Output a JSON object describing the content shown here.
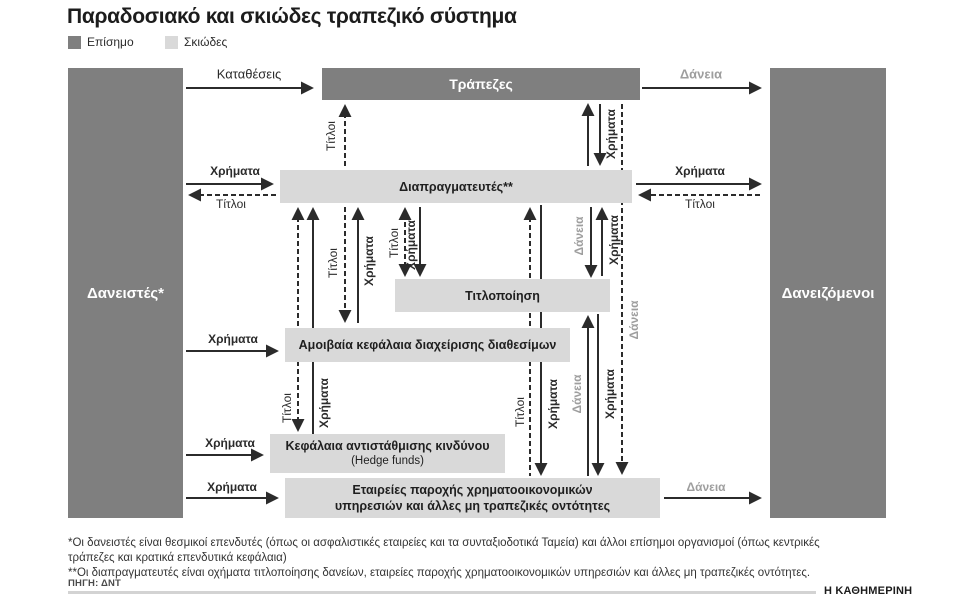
{
  "title": "Παραδοσιακό και σκιώδες τραπεζικό σύστημα",
  "legend": {
    "official": "Επίσημο",
    "shadow": "Σκιώδες"
  },
  "nodes": {
    "lenders": "Δανειστές*",
    "borrowers": "Δανειζόμενοι",
    "banks": "Τράπεζες",
    "dealers": "Διαπραγματευτές**",
    "securitization": "Τιτλοποίηση",
    "money_market_funds": "Αμοιβαία κεφάλαια διαχείρισης διαθεσίμων",
    "hedge_funds": "Κεφάλαια αντιστάθμισης κινδύνου",
    "hedge_funds_sub": "(Hedge funds)",
    "finance_companies_line1": "Εταιρείες παροχής χρηματοοικονομικών",
    "finance_companies_line2": "υπηρεσιών και άλλες μη τραπεζικές οντότητες"
  },
  "flow_labels": {
    "deposits": "Καταθέσεις",
    "loans": "Δάνεια",
    "money": "Χρήματα",
    "securities": "Τίτλοι"
  },
  "footnotes": {
    "line1": "*Οι δανειστές είναι θεσμικοί επενδυτές (όπως οι ασφαλιστικές εταιρείες και τα συνταξιοδοτικά Ταμεία) και άλλοι επίσημοι οργανισμοί (όπως κεντρικές",
    "line2": "τράπεζες και κρατικά επενδυτικά κεφάλαια)",
    "line3": "**Οι διαπραγματευτές είναι οχήματα τιτλοποίησης δανείων, εταιρείες παροχής χρηματοοικονομικών υπηρεσιών και άλλες μη τραπεζικές οντότητες."
  },
  "source": "ΠΗΓΗ: ΔΝΤ",
  "brand": "Η ΚΑΘΗΜΕΡΙΝΗ",
  "colors": {
    "official": "#7f7f7f",
    "shadow": "#d9d9d9",
    "loans": "#9e9e9e",
    "ink": "#2b2b2b"
  }
}
